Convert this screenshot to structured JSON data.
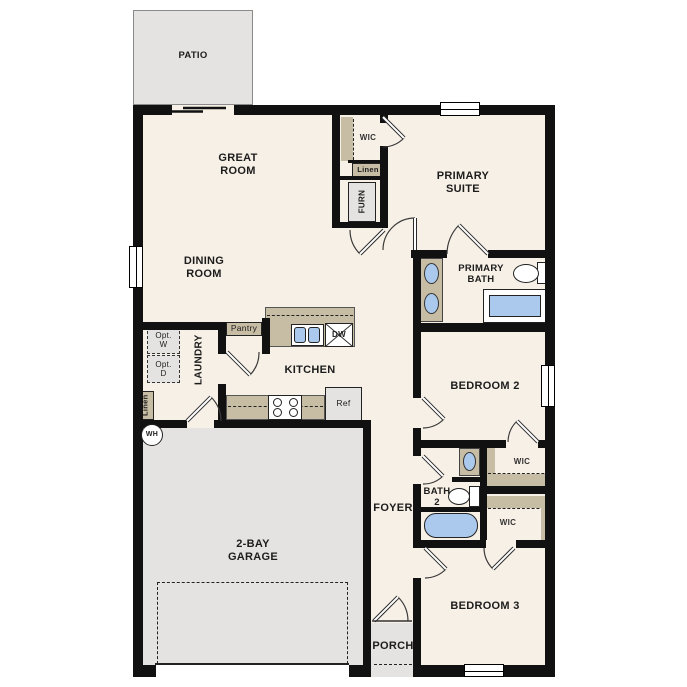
{
  "labels": {
    "patio": "PATIO",
    "great_room": "GREAT\nROOM",
    "dining_room": "DINING\nROOM",
    "primary_suite": "PRIMARY\nSUITE",
    "primary_bath": "PRIMARY\nBATH",
    "wic_primary": "WIC",
    "linen_hall": "Linen",
    "furnace": "FURN",
    "pantry": "Pantry",
    "kitchen": "KITCHEN",
    "dishwasher": "DW",
    "refrigerator": "Ref",
    "opt_washer": "Opt.\nW",
    "opt_dryer": "Opt.\nD",
    "laundry": "LAUNDRY",
    "linen_laundry": "Linen",
    "water_heater": "WH",
    "garage": "2-BAY\nGARAGE",
    "foyer": "FOYER",
    "bedroom2": "BEDROOM 2",
    "wic_bedroom2": "WIC",
    "bath2": "BATH\n2",
    "wic_bedroom3": "WIC",
    "bedroom3": "BEDROOM 3",
    "porch": "PORCH"
  },
  "colors": {
    "wall": "#111111",
    "interior_floor": "#f7f0e6",
    "concrete": "#e4e3e1",
    "cabinet_tan": "#c7bca4",
    "fixture_blue": "#abc9ec"
  }
}
